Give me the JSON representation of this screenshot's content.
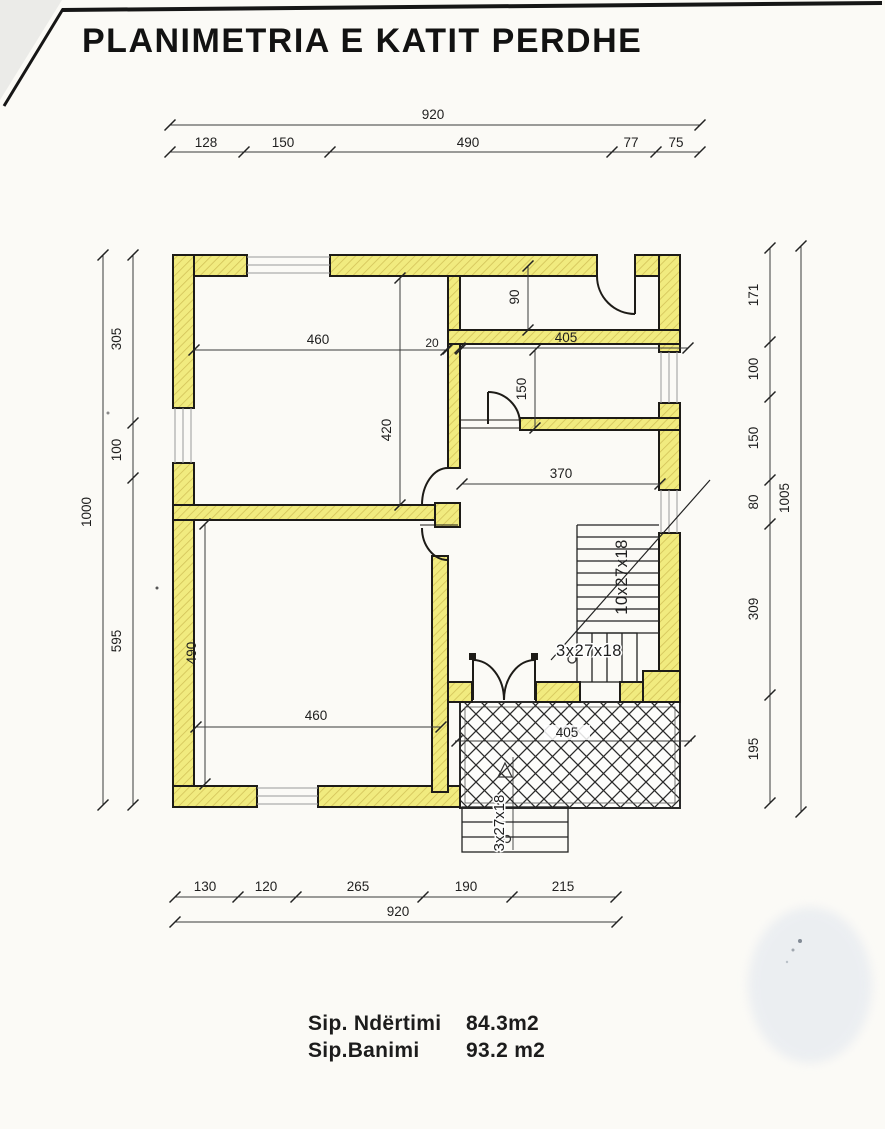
{
  "title": "PLANIMETRIA E KATIT PERDHE",
  "dims_top": {
    "total": "920",
    "segments": [
      "128",
      "150",
      "490",
      "77",
      "75"
    ]
  },
  "dims_bottom": {
    "segments": [
      "130",
      "120",
      "265",
      "190",
      "215"
    ],
    "total": "920"
  },
  "dims_left": {
    "segments": [
      "305",
      "100",
      "595"
    ],
    "total": "1000"
  },
  "dims_right": {
    "segments": [
      "171",
      "100",
      "150",
      "80",
      "309",
      "195"
    ],
    "total": "1005"
  },
  "dims_interior": {
    "top_room_width": "460",
    "top_room_height": "420",
    "corridor_height": "90",
    "wall_thickness": "20",
    "upper_right_width": "405",
    "mid_room_height": "150",
    "hall_width": "370",
    "bottom_room_height": "490",
    "bottom_room_width": "460",
    "terrace_width": "405"
  },
  "stairs": {
    "main": "10x27x18",
    "landing": "3x27x18",
    "entry": "3x27x18"
  },
  "areas": {
    "construction_label": "Sip. Ndërtimi",
    "construction_value": "84.3m2",
    "living_label": "Sip.Banimi",
    "living_value": "93.2 m2"
  },
  "colors": {
    "wall_fill": "#f1eb7f",
    "wall_hatch": "#d2c258",
    "outline": "#1d1b17",
    "dim_line": "#3a3a3a",
    "paper": "#fbfaf6",
    "smudge": "#dfe5ee"
  }
}
